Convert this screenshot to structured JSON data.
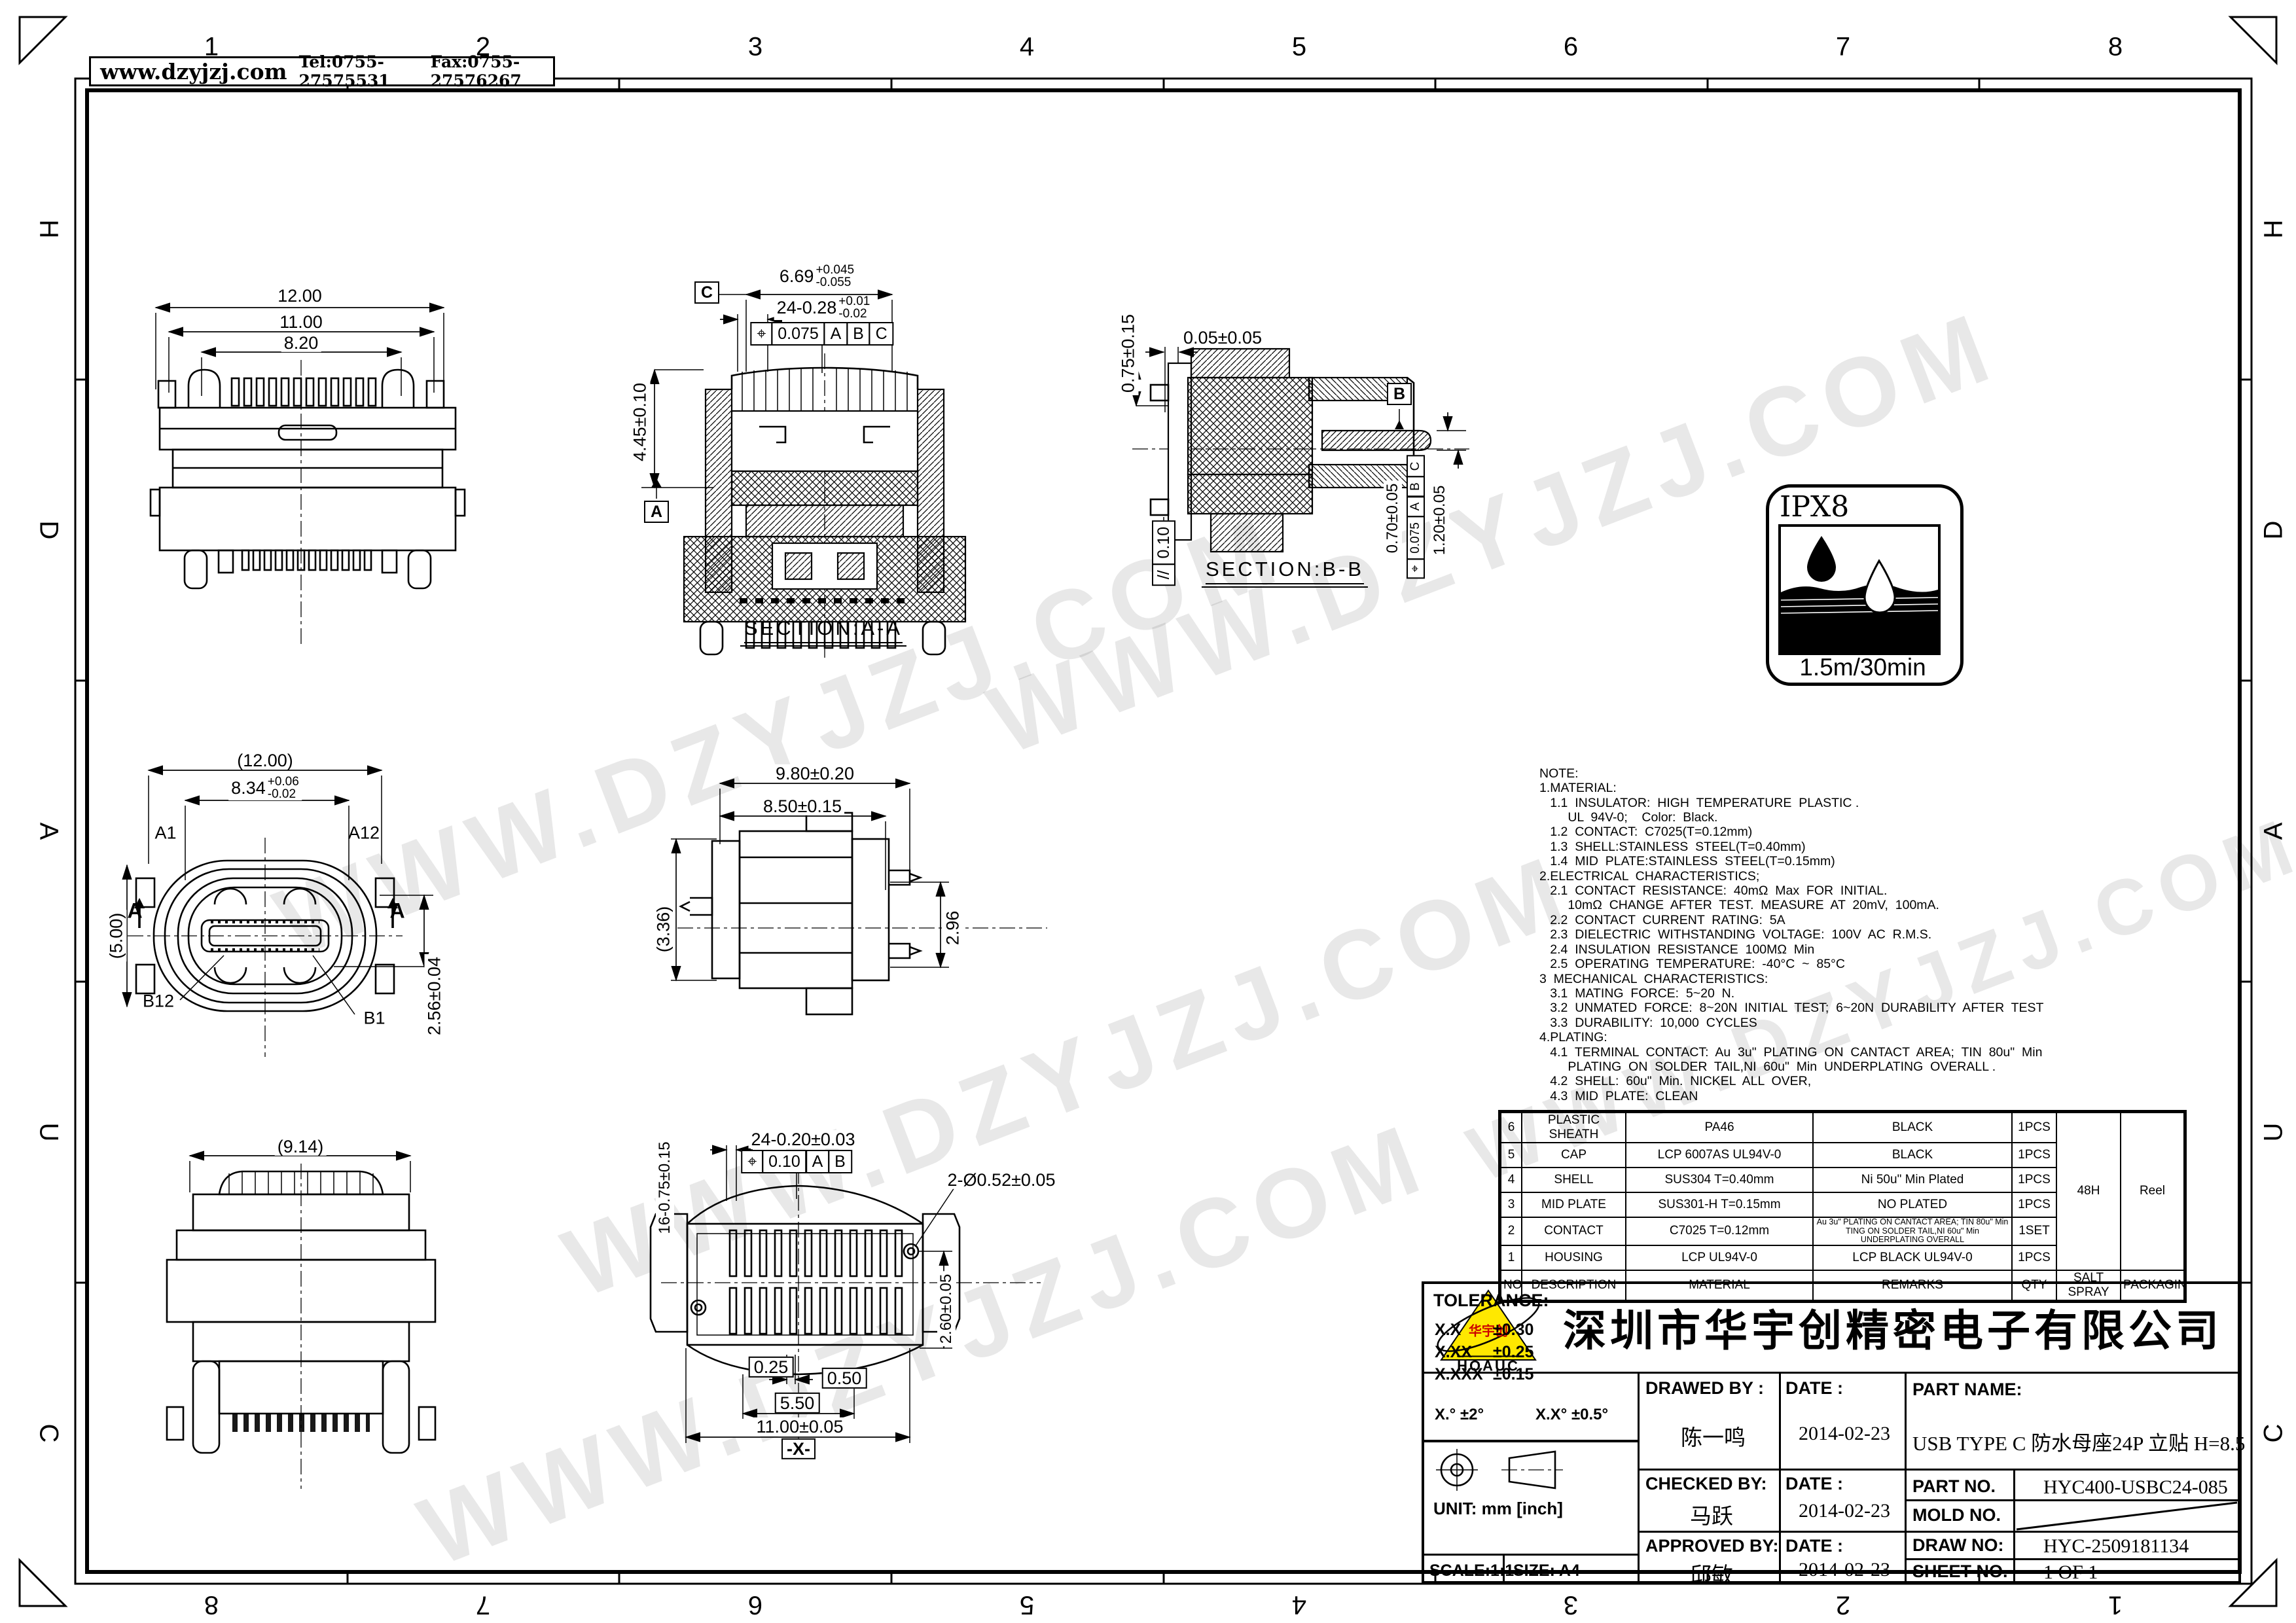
{
  "sheet": {
    "watermark": "WWW.DZYJZJ.COM",
    "header": {
      "website": "www.dzyjzj.com",
      "tel": "Tel:0755-27575531",
      "fax": "Fax:0755-27576267"
    },
    "zones": {
      "top": [
        "1",
        "2",
        "3",
        "4",
        "5",
        "6",
        "7",
        "8"
      ],
      "bottom": [
        "8",
        "7",
        "6",
        "5",
        "4",
        "3",
        "2",
        "1"
      ],
      "left": [
        "H",
        "D",
        "A",
        "U",
        "C"
      ],
      "right": [
        "H",
        "D",
        "A",
        "U",
        "C"
      ]
    }
  },
  "views": {
    "rear": {
      "d1": "12.00",
      "d2": "11.00",
      "d3": "8.20"
    },
    "secAA": {
      "label": "SECTION:A-A",
      "datum_c": "C",
      "datum_a": "A",
      "d445": "4.45±0.10",
      "d669": {
        "base": "6.69",
        "p": "+0.045",
        "m": "-0.055"
      },
      "d24": {
        "base": "24-0.28",
        "p": "+0.01",
        "m": "-0.02"
      },
      "fcf": {
        "sym": "⌖",
        "tol": "0.075",
        "a": "A",
        "b": "B",
        "c": "C"
      }
    },
    "secBB": {
      "label": "SECTION:B-B",
      "datum_b": "B",
      "d075": "0.75±0.15",
      "d005": "0.05±0.05",
      "d070": "0.70±0.05",
      "d120": "1.20±0.05",
      "fcf": {
        "sym": "⌖",
        "tol": "0.075",
        "a": "A",
        "b": "B",
        "c": "C"
      },
      "par": {
        "sym": "//",
        "tol": "0.10"
      }
    },
    "front": {
      "d12": "(12.00)",
      "d834": {
        "base": "8.34",
        "p": "+0.06",
        "m": "-0.02"
      },
      "a1": "A1",
      "a12": "A12",
      "b12": "B12",
      "b1": "B1",
      "d256": "2.56±0.04",
      "d500": "(5.00)",
      "cut": "A"
    },
    "side": {
      "d980": "9.80±0.20",
      "d850": "8.50±0.15",
      "d336": "(3.36)",
      "d296": "2.96"
    },
    "bottom": {
      "d24": "24-0.20±0.03",
      "holes": "2-Ø0.52±0.05",
      "d16": "16-0.75±0.15",
      "d025": "0.25",
      "d050": "0.50",
      "d550": "5.50",
      "d1100": "11.00±0.05",
      "dx": "-X-",
      "d260": "2.60±0.05",
      "fcf": {
        "sym": "⌖",
        "tol": "0.10",
        "a": "A",
        "b": "B"
      }
    },
    "rear2": {
      "d914": "(9.14)"
    }
  },
  "ipx8": {
    "title": "IPX8",
    "rating": "1.5m/30min"
  },
  "notes": {
    "lines": [
      "NOTE:",
      "1.MATERIAL:",
      "   1.1  INSULATOR:  HIGH  TEMPERATURE  PLASTIC .",
      "        UL  94V-0;    Color:  Black.",
      "   1.2  CONTACT:  C7025(T=0.12mm)",
      "   1.3  SHELL:STAINLESS  STEEL(T=0.40mm)",
      "   1.4  MID  PLATE:STAINLESS  STEEL(T=0.15mm)",
      "2.ELECTRICAL  CHARACTERISTICS;",
      "   2.1  CONTACT  RESISTANCE:  40mΩ  Max  FOR  INITIAL.",
      "        10mΩ  CHANGE  AFTER  TEST.  MEASURE  AT  20mV,  100mA.",
      "   2.2  CONTACT  CURRENT  RATING:  5A",
      "   2.3  DIELECTRIC  WITHSTANDING  VOLTAGE:  100V  AC  R.M.S.",
      "   2.4  INSULATION  RESISTANCE  100MΩ  Min",
      "   2.5  OPERATING  TEMPERATURE:  -40°C  ~  85°C",
      "3  MECHANICAL  CHARACTERISTICS:",
      "   3.1  MATING  FORCE:  5~20  N.",
      "   3.2  UNMATED  FORCE:  8~20N  INITIAL  TEST;  6~20N  DURABILITY  AFTER  TEST",
      "   3.3  DURABILITY:  10,000  CYCLES",
      "4.PLATING:",
      "   4.1  TERMINAL  CONTACT:  Au  3u\"  PLATING  ON  CANTACT  AREA;  TIN  80u\"  Min",
      "        PLATING  ON  SOLDER  TAIL,NI  60u\"  Min  UNDERPLATING  OVERALL .",
      "   4.2  SHELL:  60u\"  Min.  NICKEL  ALL  OVER,",
      "   4.3  MID  PLATE:  CLEAN"
    ]
  },
  "bom": {
    "headers": {
      "no": "NO.",
      "description": "DESCRIPTION",
      "material": "MATERIAL",
      "remarks": "REMARKS",
      "qty": "QTY",
      "salt": "SALT SPRAY",
      "packaging": "PACKAGING"
    },
    "salt": "48H",
    "packaging": "Reel",
    "rows": [
      {
        "no": "6",
        "d": "PLASTIC SHEATH",
        "m": "PA46",
        "r": "BLACK",
        "q": "1PCS"
      },
      {
        "no": "5",
        "d": "CAP",
        "m": "LCP 6007AS UL94V-0",
        "r": "BLACK",
        "q": "1PCS"
      },
      {
        "no": "4",
        "d": "SHELL",
        "m": "SUS304 T=0.40mm",
        "r": "Ni 50u\" Min Plated",
        "q": "1PCS"
      },
      {
        "no": "3",
        "d": "MID PLATE",
        "m": "SUS301-H T=0.15mm",
        "r": "NO  PLATED",
        "q": "1PCS"
      },
      {
        "no": "2",
        "d": "CONTACT",
        "m": "C7025 T=0.12mm",
        "r": "Au 3u\" PLATING ON CANTACT AREA; TIN 80u\" Min TING ON SOLDER TAIL,NI 60u\" Min UNDERPLATING OVERALL",
        "q": "1SET"
      },
      {
        "no": "1",
        "d": "HOUSING",
        "m": "LCP  UL94V-0",
        "r": "LCP BLACK UL94V-0",
        "q": "1PCS"
      }
    ]
  },
  "title_block": {
    "company": "深圳市华宇创精密电子有限公司",
    "logo": {
      "brand": "华宇创",
      "sub": "HOAUC"
    },
    "tolerance": {
      "label": "TOLERANCE:",
      "r1l": "X.X",
      "r1v": "±0.30",
      "r2l": "X.XX",
      "r2v": "±0.25",
      "r3l": "X.XXX",
      "r3v": "±0.15",
      "a1": "X.°  ±2°",
      "a2": "X.X°  ±0.5°"
    },
    "unit": "UNIT:  mm  [inch]",
    "scale": "SCALE:1:1",
    "size": "SIZE:  A4",
    "drawn_label": "DRAWED BY :",
    "drawn_name": "陈一鸣",
    "drawn_date_label": "DATE :",
    "drawn_date": "2014-02-23",
    "checked_label": "CHECKED BY:",
    "checked_name": "马跃",
    "checked_date_label": "DATE :",
    "checked_date": "2014-02-23",
    "approved_label": "APPROVED BY:",
    "approved_name": "邱敏",
    "approved_date_label": "DATE :",
    "approved_date": "2014-02-23",
    "part_name_label": "PART NAME:",
    "part_name": "USB TYPE C 防水母座24P 立贴 H=8.5",
    "part_no_label": "PART NO.",
    "part_no": "HYC400-USBC24-085",
    "mold_no_label": "MOLD NO.",
    "mold_no": "",
    "draw_no_label": "DRAW NO:",
    "draw_no": "HYC-2509181134",
    "sheet_no_label": "SHEET NO.",
    "sheet_no": "1 OF 1"
  }
}
